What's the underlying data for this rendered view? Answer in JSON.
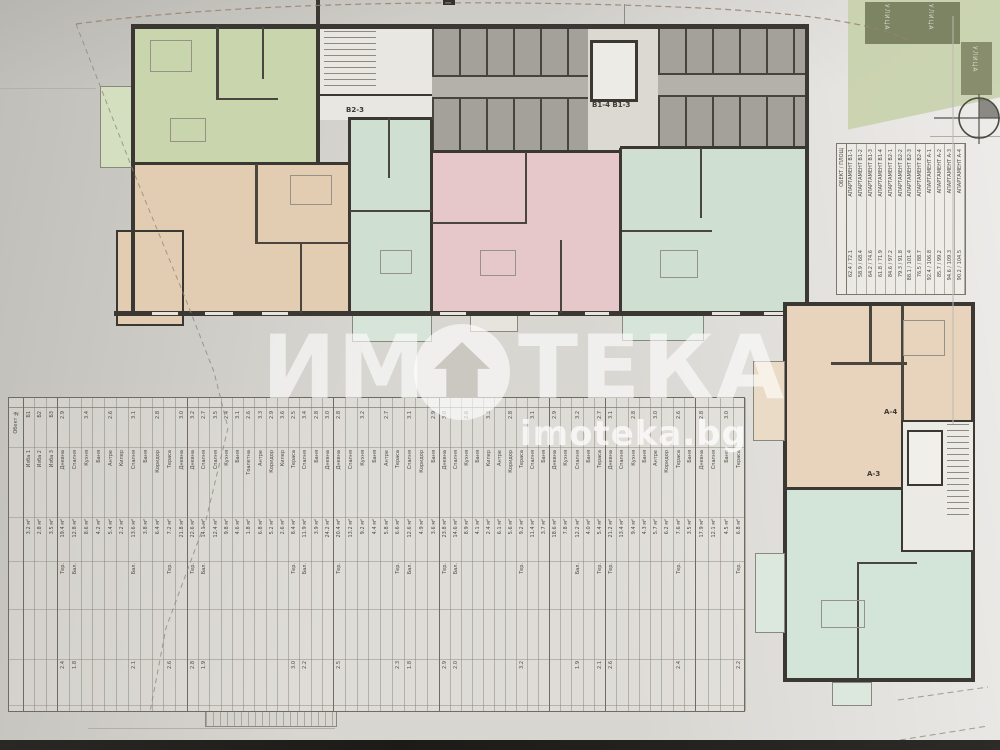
{
  "photo": {
    "watermark_text_1": "ИМ",
    "watermark_text_2": "ТЕКА",
    "watermark_url": "imoteka.bg"
  },
  "floor_plan": {
    "unit_labels": {
      "b2_3": "В2-3",
      "b1_4_b1_3": "В1-4 В1-3",
      "a_4": "А-4",
      "a_3": "А-3"
    },
    "site": {
      "street_label_1": "УЛИЦА",
      "street_label_2": "УЛИЦА",
      "street_label_3": "УЛИЦА"
    }
  },
  "legend_table": {
    "side_label": "ОБЕКТ / ПЛОЩ",
    "cols": [
      {
        "name": "АПАРТАМЕНТ В1-1",
        "v": "62.4 / 72.1"
      },
      {
        "name": "АПАРТАМЕНТ В1-2",
        "v": "58.9 / 68.4"
      },
      {
        "name": "АПАРТАМЕНТ В1-3",
        "v": "64.2 / 74.6"
      },
      {
        "name": "АПАРТАМЕНТ В1-4",
        "v": "61.8 / 71.9"
      },
      {
        "name": "АПАРТАМЕНТ В2-1",
        "v": "84.6 / 97.2"
      },
      {
        "name": "АПАРТАМЕНТ В2-2",
        "v": "79.3 / 91.8"
      },
      {
        "name": "АПАРТАМЕНТ В2-3",
        "v": "88.1 / 101.4"
      },
      {
        "name": "АПАРТАМЕНТ В2-4",
        "v": "76.5 / 88.7"
      },
      {
        "name": "АПАРТАМЕНТ А-1",
        "v": "92.4 / 106.8"
      },
      {
        "name": "АПАРТАМЕНТ А-2",
        "v": "85.7 / 99.2"
      },
      {
        "name": "АПАРТАМЕНТ А-3",
        "v": "94.6 / 109.3"
      },
      {
        "name": "АПАРТАМЕНТ А-4",
        "v": "90.2 / 104.5"
      }
    ]
  },
  "area_table": {
    "corner_label": "Обект №",
    "groups": [
      {
        "cols": [
          [
            "Б1",
            "Изба 1",
            "3.2 м²",
            "",
            ""
          ],
          [
            "Б2",
            "Изба 2",
            "2.8 м²",
            "",
            ""
          ],
          [
            "Б3",
            "Изба 3",
            "3.5 м²",
            "",
            ""
          ]
        ]
      },
      {
        "cols": [
          [
            "2.9",
            "Дневна",
            "19.4 м²",
            "Тер.",
            "2.4"
          ],
          [
            "",
            "Спалня",
            "12.8 м²",
            "Бал.",
            "1.8"
          ],
          [
            "3.4",
            "Кухня",
            "8.6 м²",
            "",
            ""
          ],
          [
            "",
            "Баня",
            "4.2 м²",
            "",
            ""
          ],
          [
            "2.6",
            "Антре",
            "5.4 м²",
            "",
            ""
          ],
          [
            "",
            "Килер",
            "2.2 м²",
            "",
            ""
          ],
          [
            "3.1",
            "Спалня",
            "13.6 м²",
            "Бал.",
            "2.1"
          ],
          [
            "",
            "Баня",
            "3.8 м²",
            "",
            ""
          ],
          [
            "2.8",
            "Коридор",
            "6.4 м²",
            "",
            ""
          ],
          [
            "",
            "Тераса",
            "7.2 м²",
            "Тер.",
            "2.6"
          ],
          [
            "3.0",
            "Дневна",
            "21.8 м²",
            "",
            ""
          ]
        ]
      },
      {
        "cols": [
          [
            "3.2",
            "Дневна",
            "22.6 м²",
            "Тер.",
            "2.8"
          ],
          [
            "2.7",
            "Спалня",
            "14.1 м²",
            "Бал.",
            "1.9"
          ],
          [
            "3.5",
            "Спалня",
            "12.4 м²",
            "",
            ""
          ],
          [
            "2.4",
            "Кухня",
            "9.8 м²",
            "",
            ""
          ],
          [
            "3.1",
            "Баня",
            "4.6 м²",
            "",
            ""
          ],
          [
            "2.6",
            "Тоалетна",
            "1.8 м²",
            "",
            ""
          ],
          [
            "3.3",
            "Антре",
            "6.8 м²",
            "",
            ""
          ],
          [
            "2.9",
            "Коридор",
            "5.2 м²",
            "",
            ""
          ],
          [
            "3.6",
            "Килер",
            "2.6 м²",
            "",
            ""
          ],
          [
            "2.5",
            "Тераса",
            "8.4 м²",
            "Тер.",
            "3.0"
          ],
          [
            "3.4",
            "Спалня",
            "11.9 м²",
            "Бал.",
            "2.2"
          ],
          [
            "2.8",
            "Баня",
            "3.9 м²",
            "",
            ""
          ],
          [
            "3.0",
            "Дневна",
            "24.2 м²",
            "",
            ""
          ]
        ]
      },
      {
        "cols": [
          [
            "2.8",
            "Дневна",
            "20.4 м²",
            "Тер.",
            "2.5"
          ],
          [
            "",
            "Спалня",
            "13.2 м²",
            "",
            ""
          ],
          [
            "3.2",
            "Кухня",
            "9.2 м²",
            "",
            ""
          ],
          [
            "",
            "Баня",
            "4.4 м²",
            "",
            ""
          ],
          [
            "2.7",
            "Антре",
            "5.8 м²",
            "",
            ""
          ],
          [
            "",
            "Тераса",
            "6.6 м²",
            "Тер.",
            "2.3"
          ],
          [
            "3.1",
            "Спалня",
            "12.6 м²",
            "Бал.",
            "1.8"
          ],
          [
            "",
            "Коридор",
            "4.9 м²",
            "",
            ""
          ],
          [
            "2.9",
            "Баня",
            "3.6 м²",
            "",
            ""
          ]
        ]
      },
      {
        "cols": [
          [
            "3.0",
            "Дневна",
            "23.8 м²",
            "Тер.",
            "2.9"
          ],
          [
            "",
            "Спалня",
            "14.6 м²",
            "Бал.",
            "2.0"
          ],
          [
            "2.6",
            "Кухня",
            "8.9 м²",
            "",
            ""
          ],
          [
            "",
            "Баня",
            "4.1 м²",
            "",
            ""
          ],
          [
            "3.3",
            "Килер",
            "2.4 м²",
            "",
            ""
          ],
          [
            "",
            "Антре",
            "6.1 м²",
            "",
            ""
          ],
          [
            "2.8",
            "Коридор",
            "5.6 м²",
            "",
            ""
          ],
          [
            "",
            "Тераса",
            "9.2 м²",
            "Тер.",
            "3.2"
          ],
          [
            "3.1",
            "Спалня",
            "11.4 м²",
            "",
            ""
          ],
          [
            "",
            "Баня",
            "3.7 м²",
            "",
            ""
          ]
        ]
      },
      {
        "cols": [
          [
            "2.9",
            "Дневна",
            "18.6 м²",
            "",
            ""
          ],
          [
            "",
            "Кухня",
            "7.8 м²",
            "",
            ""
          ],
          [
            "3.2",
            "Спалня",
            "12.2 м²",
            "Бал.",
            "1.9"
          ],
          [
            "",
            "Баня",
            "4.0 м²",
            "",
            ""
          ],
          [
            "2.7",
            "Тераса",
            "5.4 м²",
            "Тер.",
            "2.1"
          ]
        ]
      },
      {
        "cols": [
          [
            "3.1",
            "Дневна",
            "21.2 м²",
            "Тер.",
            "2.6"
          ],
          [
            "",
            "Спалня",
            "13.4 м²",
            "",
            ""
          ],
          [
            "2.8",
            "Кухня",
            "9.4 м²",
            "",
            ""
          ],
          [
            "",
            "Баня",
            "4.3 м²",
            "",
            ""
          ],
          [
            "3.0",
            "Антре",
            "5.7 м²",
            "",
            ""
          ],
          [
            "",
            "Коридор",
            "6.2 м²",
            "",
            ""
          ],
          [
            "2.6",
            "Тераса",
            "7.6 м²",
            "Тер.",
            "2.4"
          ],
          [
            "",
            "Баня",
            "3.5 м²",
            "",
            ""
          ]
        ]
      },
      {
        "cols": [
          [
            "2.8",
            "Дневна",
            "17.9 м²",
            "",
            ""
          ],
          [
            "",
            "Спалня",
            "12.1 м²",
            "",
            ""
          ],
          [
            "3.0",
            "Баня",
            "4.5 м²",
            "",
            ""
          ],
          [
            "",
            "Тераса",
            "6.8 м²",
            "Тер.",
            "2.2"
          ]
        ]
      }
    ]
  }
}
